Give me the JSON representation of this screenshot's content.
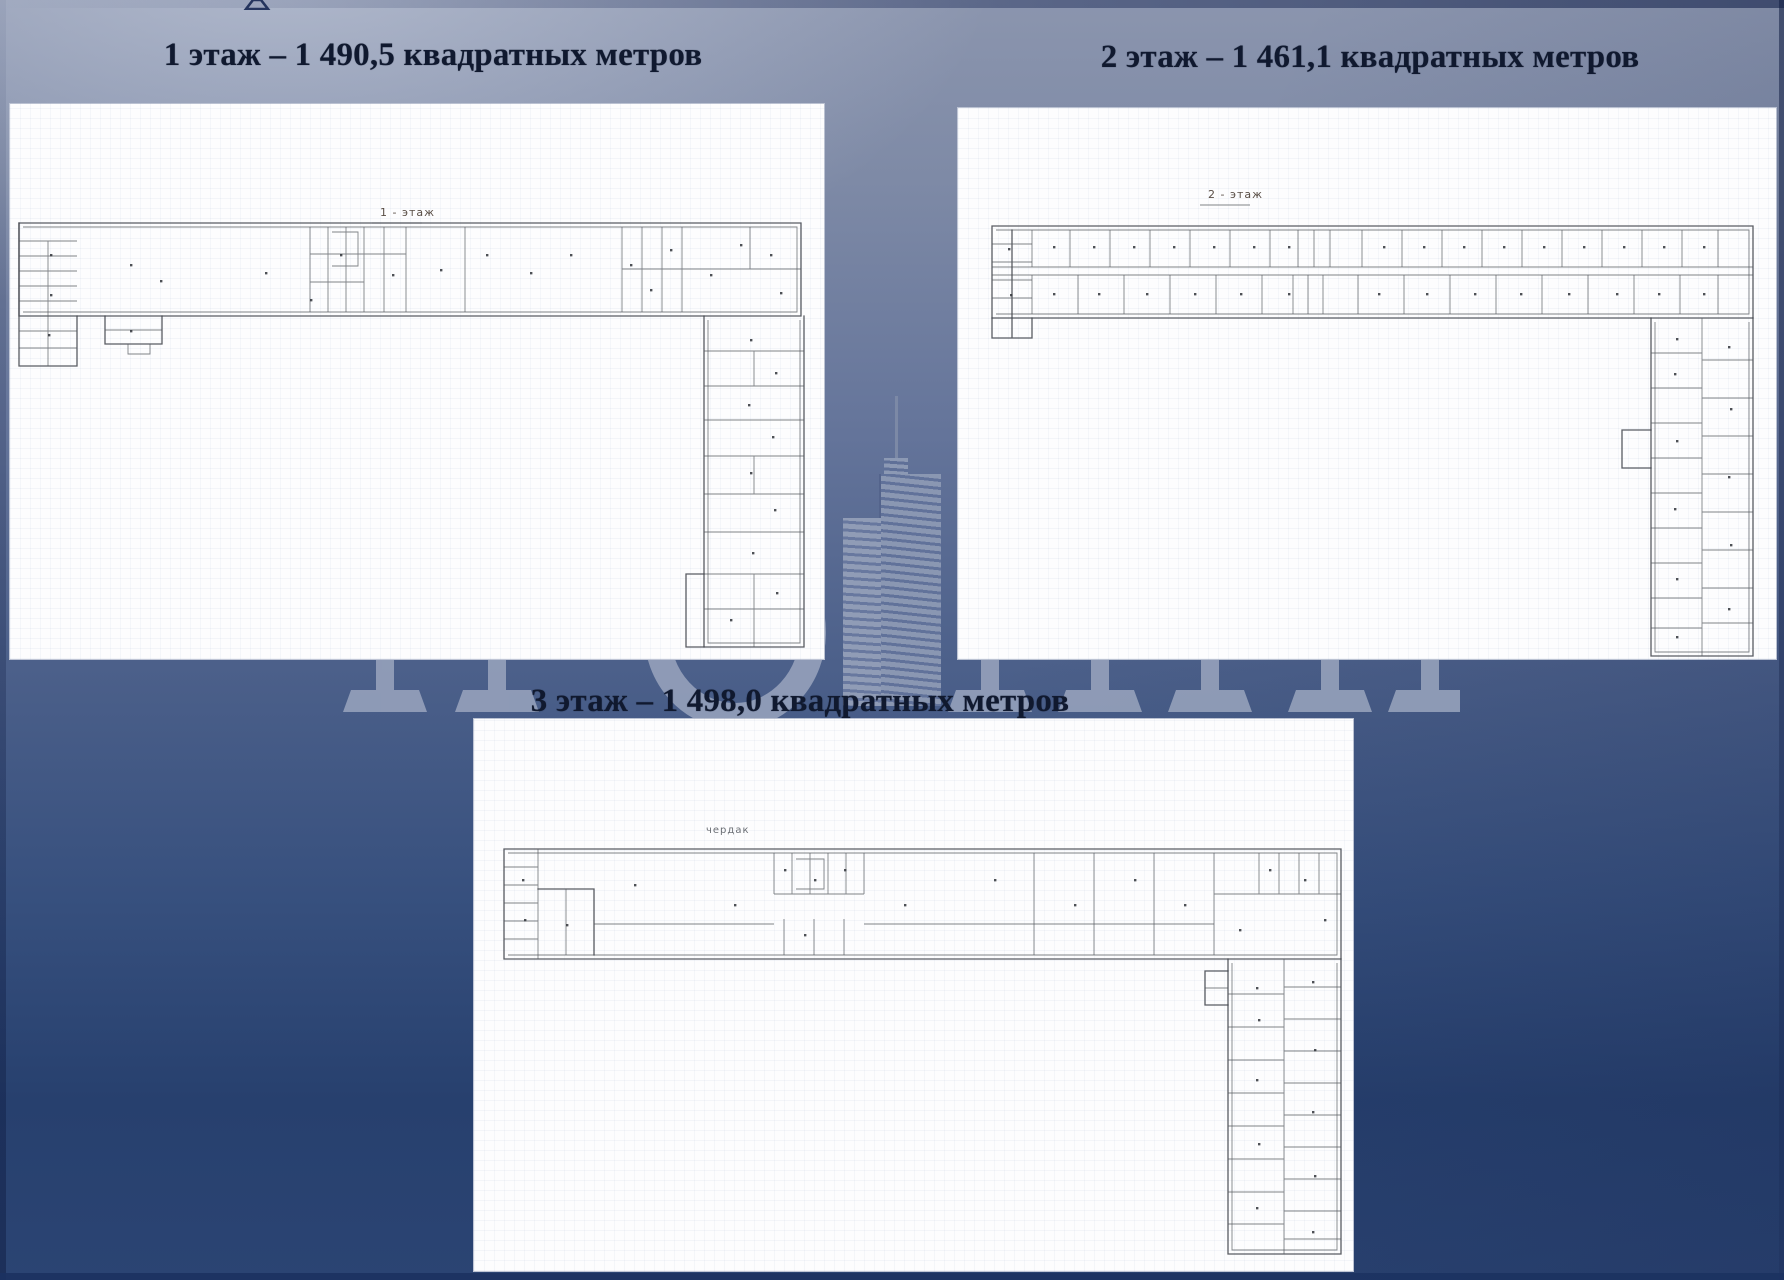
{
  "slide": {
    "titles": {
      "floor1": "1 этаж – 1 490,5 квадратных метров",
      "floor2": "2 этаж – 1 461,1 квадратных метров",
      "floor3": "3 этаж – 1 498,0 квадратных метров"
    },
    "plan_labels": {
      "floor1": "1 - этаж",
      "floor2": "2 - этаж",
      "floor3": "чердак"
    },
    "colors": {
      "background_top_left": "#9aa4ba",
      "background_bottom": "#27406e",
      "title_text": "#10192f",
      "panel_paper": "#fdfdfe",
      "plan_ink": "#43474d",
      "watermark": "#94a0ba"
    }
  }
}
